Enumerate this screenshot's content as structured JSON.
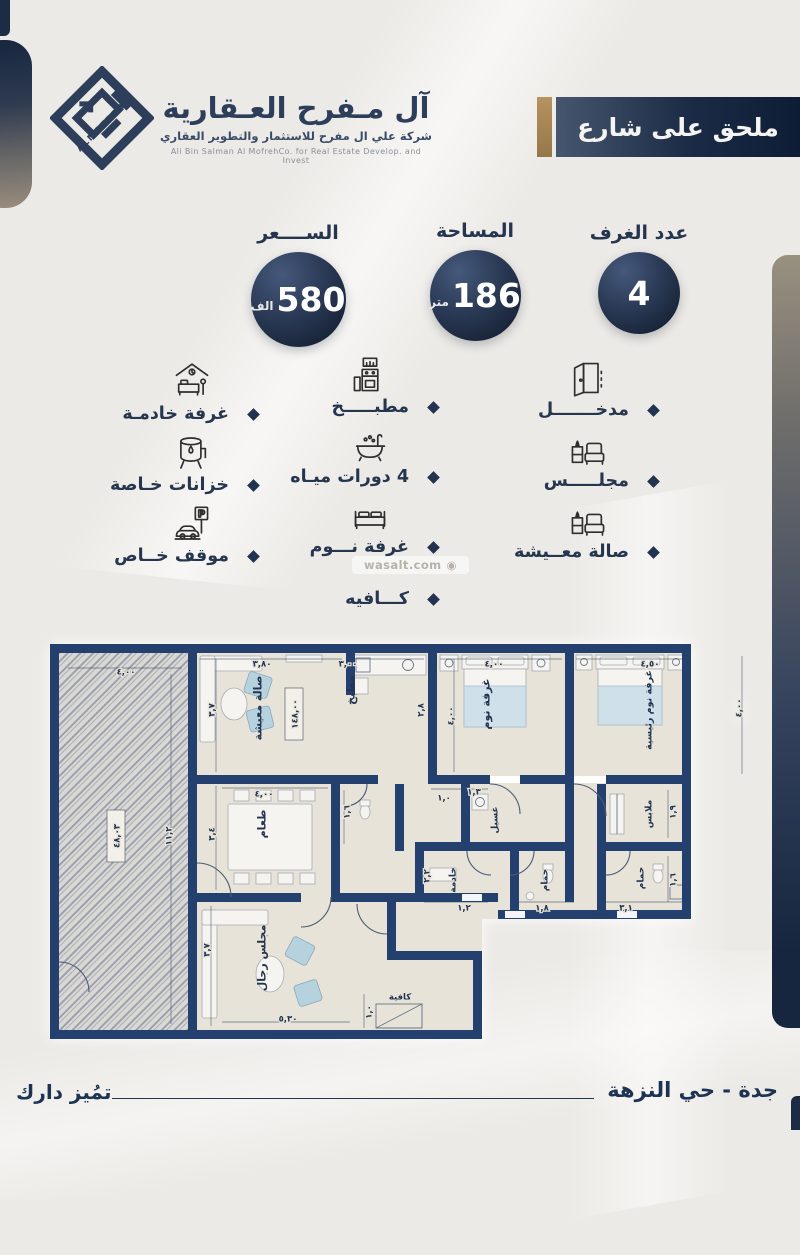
{
  "brand": {
    "logo_text": "ALMOFREH",
    "title": "آل مـفرح العـقارية",
    "subtitle": "شركة علي ال مفرح للاستثمار والتطوير العقاري",
    "subtitle_en": "Ali Bin Salman Al MofrehCo. for Real Estate Develop. and Invest"
  },
  "banner": {
    "label": "ملحق على شارع"
  },
  "stats": {
    "price": {
      "label": "الســــعر",
      "value": "580",
      "unit": "الف"
    },
    "area": {
      "label": "المساحة",
      "value": "186",
      "unit": "متر"
    },
    "rooms": {
      "label": "عدد الغرف",
      "value": "4",
      "unit": ""
    }
  },
  "features": {
    "right": [
      {
        "icon": "door-icon",
        "label": "مدخـــــــل"
      },
      {
        "icon": "majlis-sofa-icon",
        "label": "مجلـــــس"
      },
      {
        "icon": "living-sofa-icon",
        "label": "صالة معــيشة"
      }
    ],
    "middle": [
      {
        "icon": "kitchen-icon",
        "label": "مطبـــــخ"
      },
      {
        "icon": "bathtub-icon",
        "label": "4 دورات ميـاه"
      },
      {
        "icon": "bed-icon",
        "label": "غرفة نـــوم"
      },
      {
        "icon": "",
        "label": "كـــافيه"
      }
    ],
    "left": [
      {
        "icon": "maid-room-icon",
        "label": "غرفة خادمـة"
      },
      {
        "icon": "water-tank-icon",
        "label": "خزانات خـاصة"
      },
      {
        "icon": "parking-icon",
        "label": "موقف خــاص"
      }
    ]
  },
  "watermark": {
    "text": "wasalt.com"
  },
  "floorplan": {
    "rooms": [
      {
        "t": "صالة معيشة",
        "x": 208,
        "y": 64,
        "r": -90,
        "fs": 11
      },
      {
        "t": "مطبخ",
        "x": 301,
        "y": 46,
        "r": -90,
        "fs": 11
      },
      {
        "t": "غرفة نوم",
        "x": 436,
        "y": 60,
        "r": -90,
        "fs": 11
      },
      {
        "t": "غرفة نوم رئيسية",
        "x": 598,
        "y": 66,
        "r": -90,
        "fs": 9.5
      },
      {
        "t": "ملابس",
        "x": 598,
        "y": 170,
        "r": -90,
        "fs": 9
      },
      {
        "t": "حمام",
        "x": 590,
        "y": 234,
        "r": -90,
        "fs": 9
      },
      {
        "t": "حمام",
        "x": 494,
        "y": 236,
        "r": -90,
        "fs": 9
      },
      {
        "t": "خادمة",
        "x": 402,
        "y": 236,
        "r": -90,
        "fs": 9
      },
      {
        "t": "غسيل",
        "x": 444,
        "y": 176,
        "r": -90,
        "fs": 9
      },
      {
        "t": "طعام",
        "x": 212,
        "y": 180,
        "r": -90,
        "fs": 11
      },
      {
        "t": "مجلس رجال",
        "x": 212,
        "y": 314,
        "r": -90,
        "fs": 11
      },
      {
        "t": "كافية",
        "x": 350,
        "y": 352,
        "r": 0,
        "fs": 8.5
      }
    ],
    "dims": [
      {
        "t": "٤,٠٠",
        "x": 76,
        "y": 27
      },
      {
        "t": "١١,٢",
        "x": 118,
        "y": 192,
        "r": -90
      },
      {
        "t": "٤٨,٠٣",
        "x": 66,
        "y": 192,
        "r": -90,
        "boxed": true
      },
      {
        "t": "٣,٨٠",
        "x": 212,
        "y": 19
      },
      {
        "t": "٣,٧",
        "x": 161,
        "y": 66,
        "r": -90
      },
      {
        "t": "١٤٨,٠٠",
        "x": 244,
        "y": 70,
        "r": -90,
        "boxed": true
      },
      {
        "t": "٣,٠٠",
        "x": 298,
        "y": 19
      },
      {
        "t": "٢,٨",
        "x": 370,
        "y": 66,
        "r": -90
      },
      {
        "t": "٤,٠٠",
        "x": 444,
        "y": 19
      },
      {
        "t": "٤,٠٠",
        "x": 400,
        "y": 72,
        "r": -90
      },
      {
        "t": "٤,٥٠",
        "x": 600,
        "y": 19
      },
      {
        "t": "٤,٠٠",
        "x": 688,
        "y": 64,
        "r": -90
      },
      {
        "t": "١,٣",
        "x": 424,
        "y": 147
      },
      {
        "t": "١,٩",
        "x": 622,
        "y": 168,
        "r": -90
      },
      {
        "t": "١,٦",
        "x": 622,
        "y": 236,
        "r": -90
      },
      {
        "t": "٣,١",
        "x": 576,
        "y": 263
      },
      {
        "t": "١,٨",
        "x": 492,
        "y": 263
      },
      {
        "t": "١,٢",
        "x": 414,
        "y": 263
      },
      {
        "t": "٢,٢",
        "x": 376,
        "y": 232,
        "r": -90
      },
      {
        "t": "١,٠",
        "x": 394,
        "y": 153
      },
      {
        "t": "١,٦",
        "x": 296,
        "y": 168,
        "r": -90
      },
      {
        "t": "٤,٠٠",
        "x": 214,
        "y": 149
      },
      {
        "t": "٣,٤",
        "x": 161,
        "y": 190,
        "r": -90
      },
      {
        "t": "٥,٣٠",
        "x": 238,
        "y": 374
      },
      {
        "t": "٣,٧",
        "x": 156,
        "y": 306,
        "r": -90
      },
      {
        "t": "١,٠",
        "x": 318,
        "y": 368,
        "r": -90
      }
    ]
  },
  "footer": {
    "location": "جدة - حي النزهة",
    "tagline": "تمُيز دارك"
  },
  "colors": {
    "navy": "#22344f",
    "gold": "#a3814f",
    "wall": "#24406e",
    "accent_blue": "#b7d2df"
  }
}
